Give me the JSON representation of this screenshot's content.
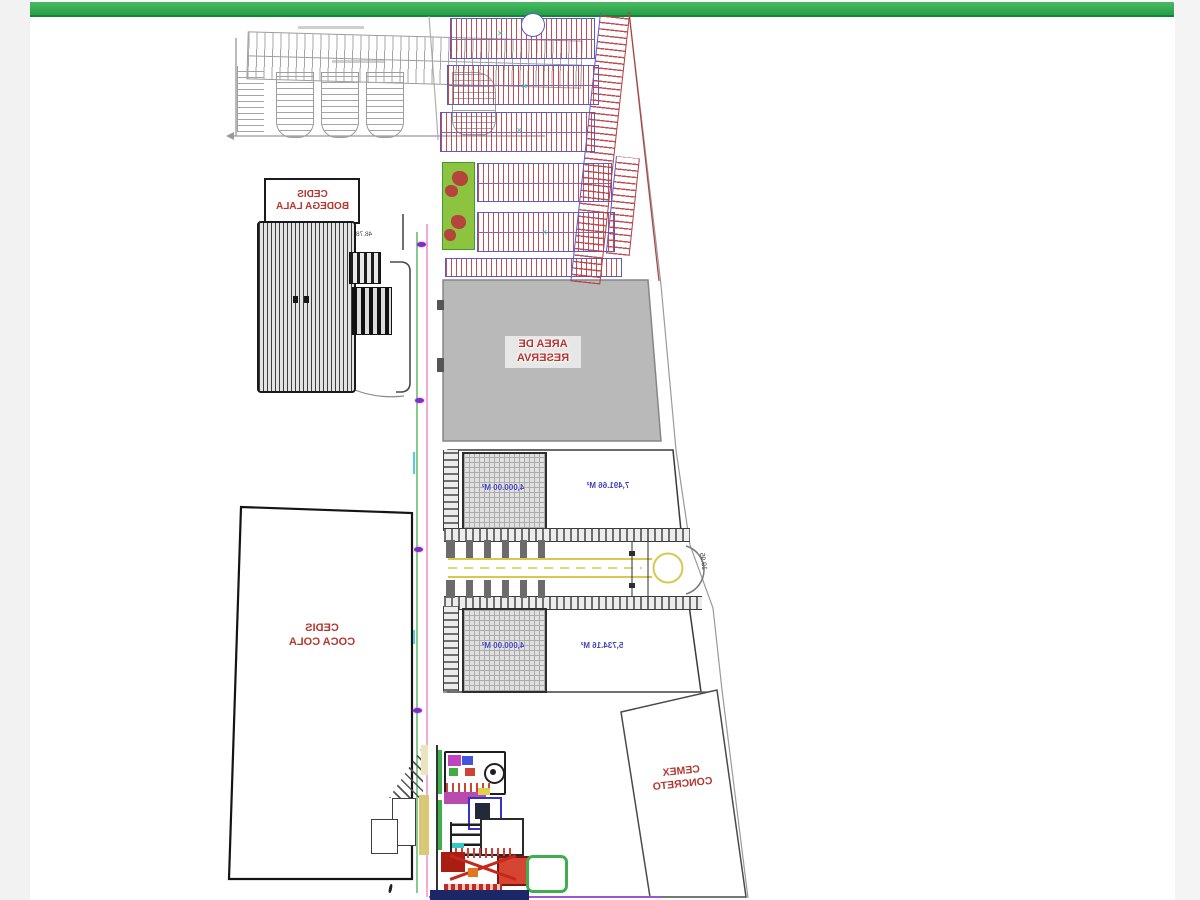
{
  "page": {
    "topbar_color": "#2fae4e",
    "margin_color": "#f2f3f2"
  },
  "plan": {
    "labels": {
      "lala": {
        "l1": "CEDIS",
        "l2": "BODEGA LALA"
      },
      "coca": {
        "l1": "CEDIS",
        "l2": "COCA COLA"
      },
      "reserva": {
        "l1": "AREA DE",
        "l2": "RESERVA"
      },
      "cemex": {
        "l1": "CEMEX",
        "l2": "CONCRETO"
      }
    },
    "areas": {
      "upper_pad": "4,000.00 M²",
      "upper_lot": "7,491.66 M²",
      "lower_pad": "4,000.00 M²",
      "lower_lot": "5,734.16 M²"
    },
    "dimensions": {
      "lala_frontage": "48.78",
      "street_dim": "19.95"
    },
    "colors": {
      "label_red": "#b5372f",
      "area_blue": "#4343bd",
      "reserve_gray": "#b9b9b9",
      "lot_outline_blue": "#5a5ac8",
      "lot_hatch_red": "#ba3a40",
      "road_green_line": "#44ae4e",
      "road_pink_line": "#ee8fc7",
      "street_yellow": "#d9c850",
      "park_green": "#8cc43f",
      "marker_purple": "#7e2ec4"
    }
  }
}
